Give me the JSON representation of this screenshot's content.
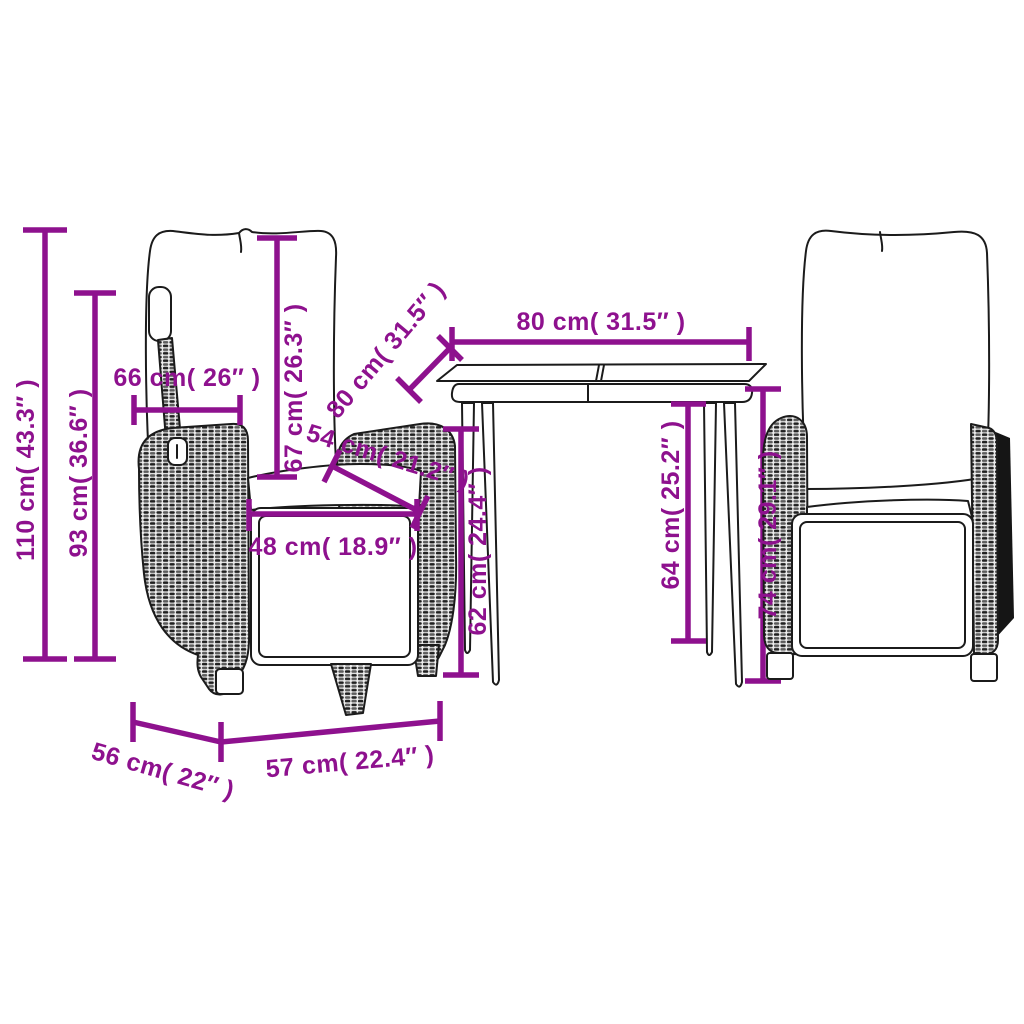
{
  "diagram": {
    "accent_color": "#8E118E",
    "outline_color": "#1b1b1b",
    "background": "#ffffff",
    "labels": {
      "chair_total_height": "110 cm( 43.3″ )",
      "chair_back_floor_height": "93 cm( 36.6″ )",
      "backrest_width": "66 cm( 26″ )",
      "backrest_height": "67 cm( 26.3″ )",
      "armrest_depth": "54 cm( 21.2″ )",
      "seat_front_width": "48 cm( 18.9″ )",
      "table_depth": "80 cm( 31.5″ )",
      "table_width": "80 cm( 31.5″ )",
      "table_clearance_height": "62 cm( 24.4″ )",
      "table_leg_height": "64 cm( 25.2″ )",
      "armrest_height": "74 cm( 29.1″ )",
      "seat_base_depth": "56 cm( 22″ )",
      "seat_base_width": "57 cm( 22.4″ )"
    }
  }
}
